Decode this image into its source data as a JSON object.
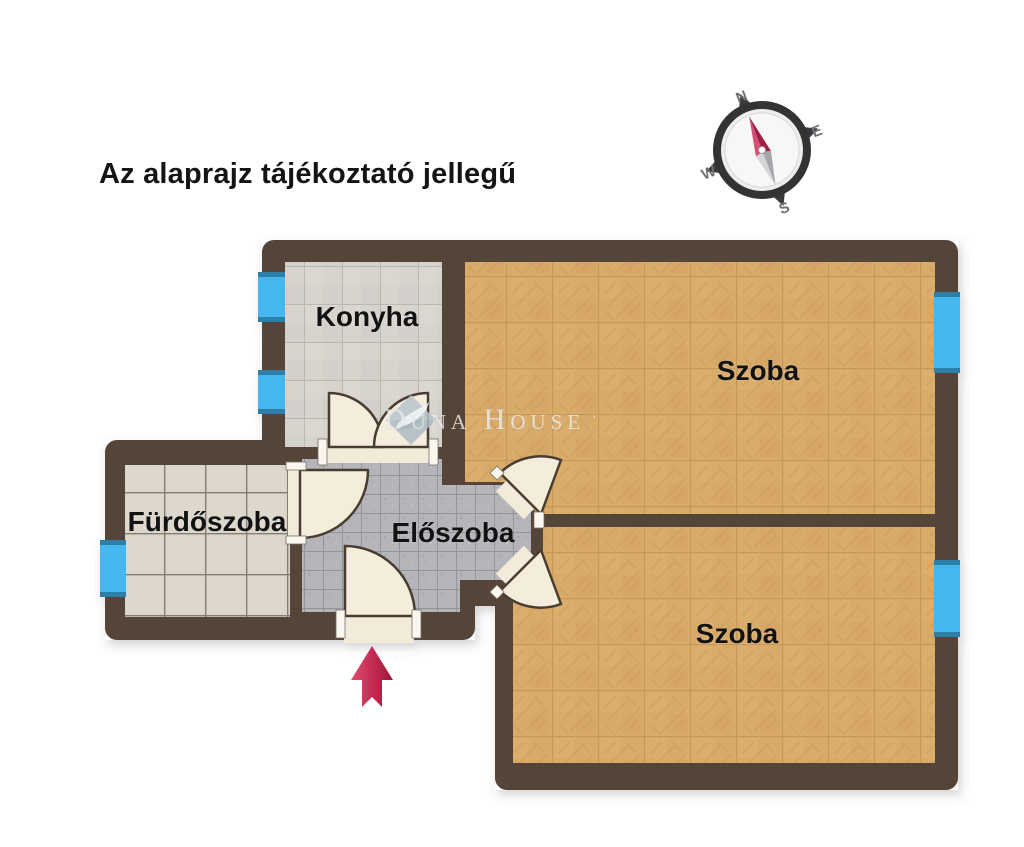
{
  "title": {
    "text": "Az alaprajz tájékoztató jellegű"
  },
  "compass": {
    "north": "N",
    "east": "E",
    "south": "S",
    "west": "W"
  },
  "watermark": {
    "brand": "Duna House",
    "mark": "’"
  },
  "rooms": {
    "konyha": {
      "label": "Konyha"
    },
    "szoba_top": {
      "label": "Szoba"
    },
    "szoba_bottom": {
      "label": "Szoba"
    },
    "furdoszoba": {
      "label": "Fürdőszoba"
    },
    "eloszoba": {
      "label": "Előszoba"
    }
  },
  "colors": {
    "background": "#ffffff",
    "wall": "#544438",
    "window_blue": "#45b7ee",
    "window_cap_blue": "#2e7fa8",
    "parquet_floor": "#d9ab68",
    "kitchen_floor": "#d7d3cd",
    "bath_floor": "#dbd5ca",
    "hall_floor": "#b4b4b9",
    "door_leaf": "#f4eddc",
    "entrance_arrow": "#c22950",
    "compass_needle_red": "#a02045",
    "text": "#141414"
  }
}
